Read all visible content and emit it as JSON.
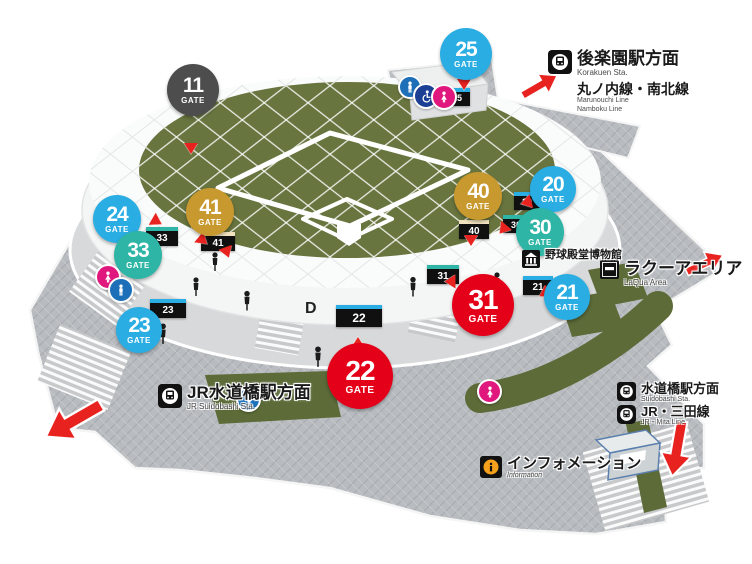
{
  "map_title": "Tokyo Dome gate guide map",
  "colors": {
    "gate_cyan": "#29ade3",
    "gate_teal": "#2eb5a5",
    "gate_gold": "#c8992f",
    "gate_red": "#e50019",
    "gate_dark": "#4d4d4d",
    "arrow_red": "#e8231f",
    "field_green": "#68753f",
    "hedge_green": "#5c6b38",
    "plaza_gray": "#b8bcc0"
  },
  "gates": [
    {
      "number": "11",
      "word": "GATE",
      "color": "dark"
    },
    {
      "number": "25",
      "word": "GATE",
      "color": "cyan"
    },
    {
      "number": "24",
      "word": "GATE",
      "color": "cyan"
    },
    {
      "number": "41",
      "word": "GATE",
      "color": "gold"
    },
    {
      "number": "33",
      "word": "GATE",
      "color": "teal"
    },
    {
      "number": "23",
      "word": "GATE",
      "color": "cyan"
    },
    {
      "number": "40",
      "word": "GATE",
      "color": "gold"
    },
    {
      "number": "20",
      "word": "GATE",
      "color": "cyan"
    },
    {
      "number": "30",
      "word": "GATE",
      "color": "teal"
    },
    {
      "number": "21",
      "word": "GATE",
      "color": "cyan"
    },
    {
      "number": "31",
      "word": "GATE",
      "color": "red"
    },
    {
      "number": "22",
      "word": "GATE",
      "color": "red"
    }
  ],
  "wall_signs": [
    {
      "text": "33"
    },
    {
      "text": "41"
    },
    {
      "text": "23"
    },
    {
      "text": "22"
    },
    {
      "text": "31"
    },
    {
      "text": "40"
    },
    {
      "text": "30"
    },
    {
      "text": "20"
    },
    {
      "text": "21"
    },
    {
      "text": "25"
    }
  ],
  "wall_letter": "D",
  "labels": {
    "korakuen": {
      "title": "後楽園駅方面",
      "subtitle": "Korakuen Sta.",
      "line": "丸ノ内線・南北線",
      "line_sub1": "Marunouchi Line",
      "line_sub2": "Namboku Line"
    },
    "laqua": {
      "title": "ラクーアエリア",
      "subtitle": "LaQua Area"
    },
    "museum": {
      "title": "野球殿堂博物館"
    },
    "jr_suidobashi": {
      "title": "JR水道橋駅方面",
      "subtitle": "JR Suidobashi Sta."
    },
    "suidobashi": {
      "title": "水道橋駅方面",
      "subtitle": "Suidobashi Sta."
    },
    "mita": {
      "title": "JR・三田線",
      "subtitle": "JR・Mita Line"
    },
    "information": {
      "title": "インフォメーション",
      "subtitle": "Information"
    }
  },
  "icons": {
    "train": "train-icon",
    "subway": "subway-icon",
    "museum": "museum-icon",
    "laqua": "laqua-logo-icon",
    "information": "information-icon",
    "mens": "mens-restroom-icon",
    "womens": "womens-restroom-icon",
    "accessible": "accessible-restroom-icon",
    "pointer": "gate-pointer-icon",
    "arrow": "direction-arrow-icon",
    "person": "person-figure"
  }
}
